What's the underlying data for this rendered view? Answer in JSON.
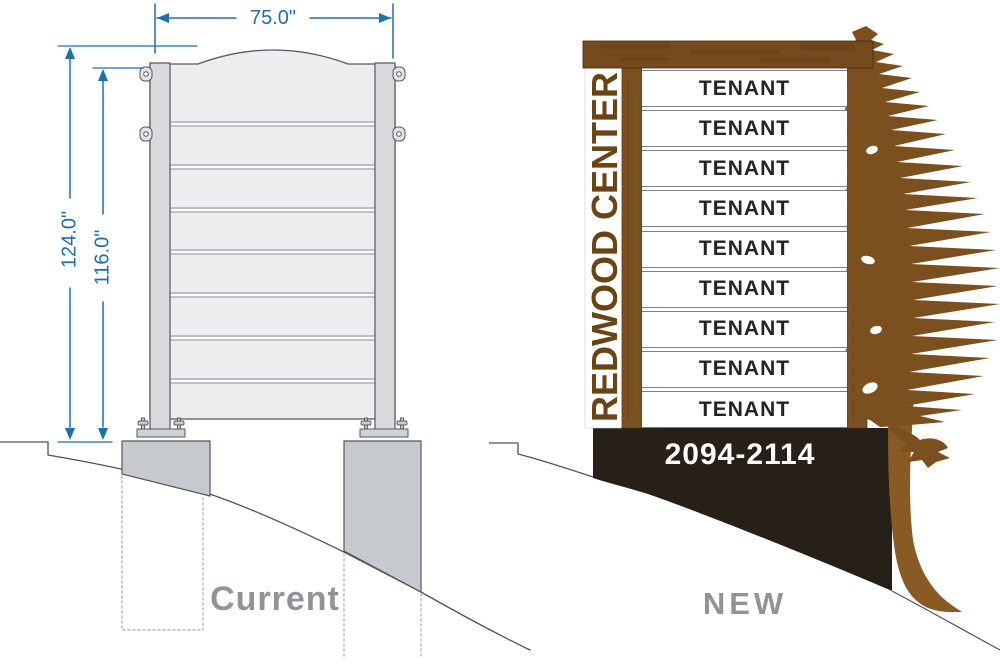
{
  "colors": {
    "dimension_blue": "#1f6fad",
    "line_gray": "#4f5357",
    "concrete_gray": "#c6cace",
    "panel_gray": "#eceef0",
    "wood_brown": "#754a1d",
    "letter_brown": "#6b4414",
    "tree_brown": "#7b4f1e",
    "trunk_brown": "#8a5a24",
    "base_black": "#272019",
    "caption_gray": "#919497"
  },
  "current_sign": {
    "caption": "Current",
    "dim_width": "75.0\"",
    "dim_height_overall": "124.0\"",
    "dim_height_structure": "116.0\""
  },
  "new_sign": {
    "caption": "NEW",
    "building_name": "REDWOOD CENTER",
    "address_range": "2094-2114",
    "tenants": [
      "TENANT",
      "TENANT",
      "TENANT",
      "TENANT",
      "TENANT",
      "TENANT",
      "TENANT",
      "TENANT",
      "TENANT"
    ]
  }
}
